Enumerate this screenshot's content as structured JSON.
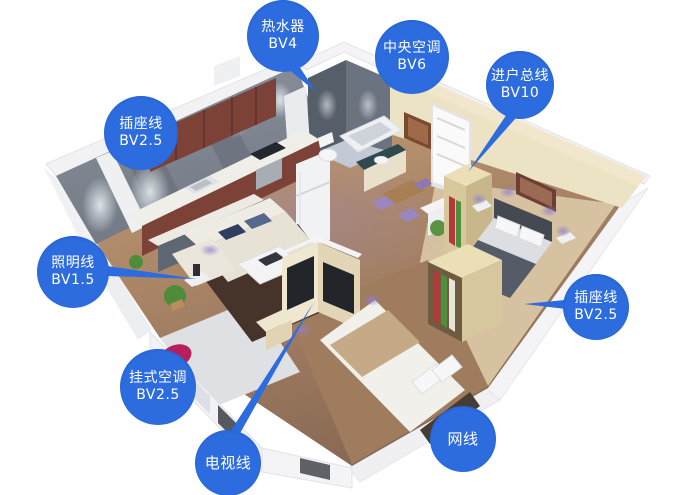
{
  "colors": {
    "label_background": "#2c6cdf",
    "label_text": "#ffffff",
    "leader_line": "#2c6cdf"
  },
  "labels": [
    {
      "id": "water-heater",
      "line1": "热水器",
      "line2": "BV4"
    },
    {
      "id": "central-ac",
      "line1": "中央空调",
      "line2": "BV6"
    },
    {
      "id": "incoming-main",
      "line1": "进户总线",
      "line2": "BV10"
    },
    {
      "id": "socket-line-left",
      "line1": "插座线",
      "line2": "BV2.5"
    },
    {
      "id": "lighting-line",
      "line1": "照明线",
      "line2": "BV1.5"
    },
    {
      "id": "wall-mounted-ac",
      "line1": "挂式空调",
      "line2": "BV2.5"
    },
    {
      "id": "tv-line",
      "line1": "电视线",
      "line2": ""
    },
    {
      "id": "network-line",
      "line1": "网线",
      "line2": ""
    },
    {
      "id": "socket-line-right",
      "line1": "插座线",
      "line2": "BV2.5"
    }
  ]
}
